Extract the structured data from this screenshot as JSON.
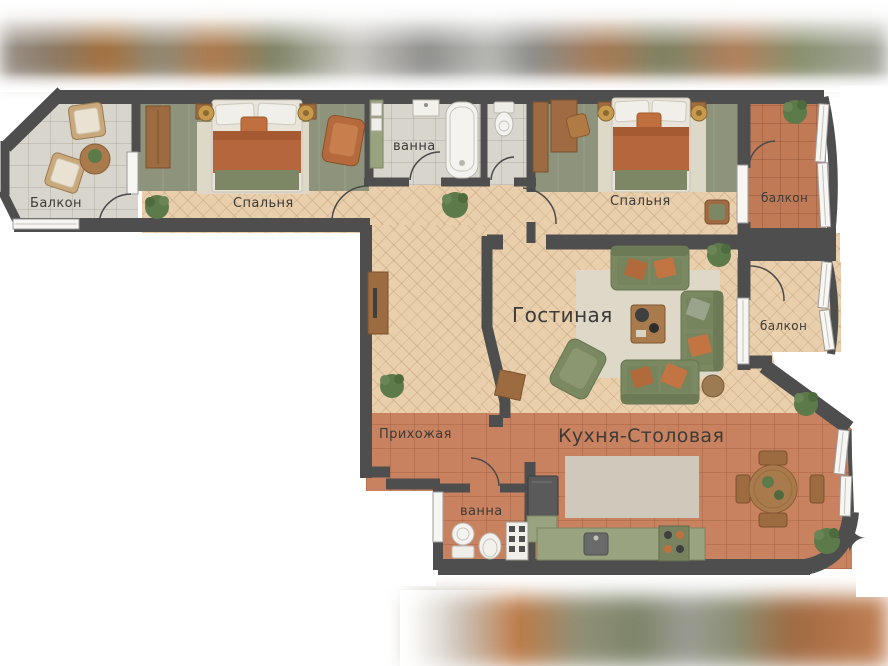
{
  "rooms": {
    "balcony_left": {
      "label": "Балкон"
    },
    "bedroom_left": {
      "label": "Спальня"
    },
    "bathroom_top": {
      "label": "ванна"
    },
    "bedroom_right": {
      "label": "Спальня"
    },
    "balcony_top_right": {
      "label": "балкон"
    },
    "living_room": {
      "label": "Гостиная"
    },
    "balcony_mid_right": {
      "label": "балкон"
    },
    "hallway": {
      "label": "Прихожая"
    },
    "kitchen_dining": {
      "label": "Кухня-Столовая"
    },
    "bathroom_bottom": {
      "label": "ванна"
    }
  },
  "icons": {
    "compass_star": "✦"
  },
  "palette": {
    "wall": "#4e4e4e",
    "parquet": "#e9cfac",
    "bedroom_floor": "#8e947b",
    "terracotta_tile": "#c9825f",
    "balcony_grey_tile": "#d8d5cd",
    "bathroom_tile": "#d6d3ca",
    "rug": "#ded8c9",
    "kitchen_rug": "#cfc9bb",
    "sofa_green": "#7b8963",
    "pillow_orange": "#c0703f",
    "wood": "#a06b42",
    "counter_green": "#9aa37f",
    "label_text": "#3c3b38"
  }
}
